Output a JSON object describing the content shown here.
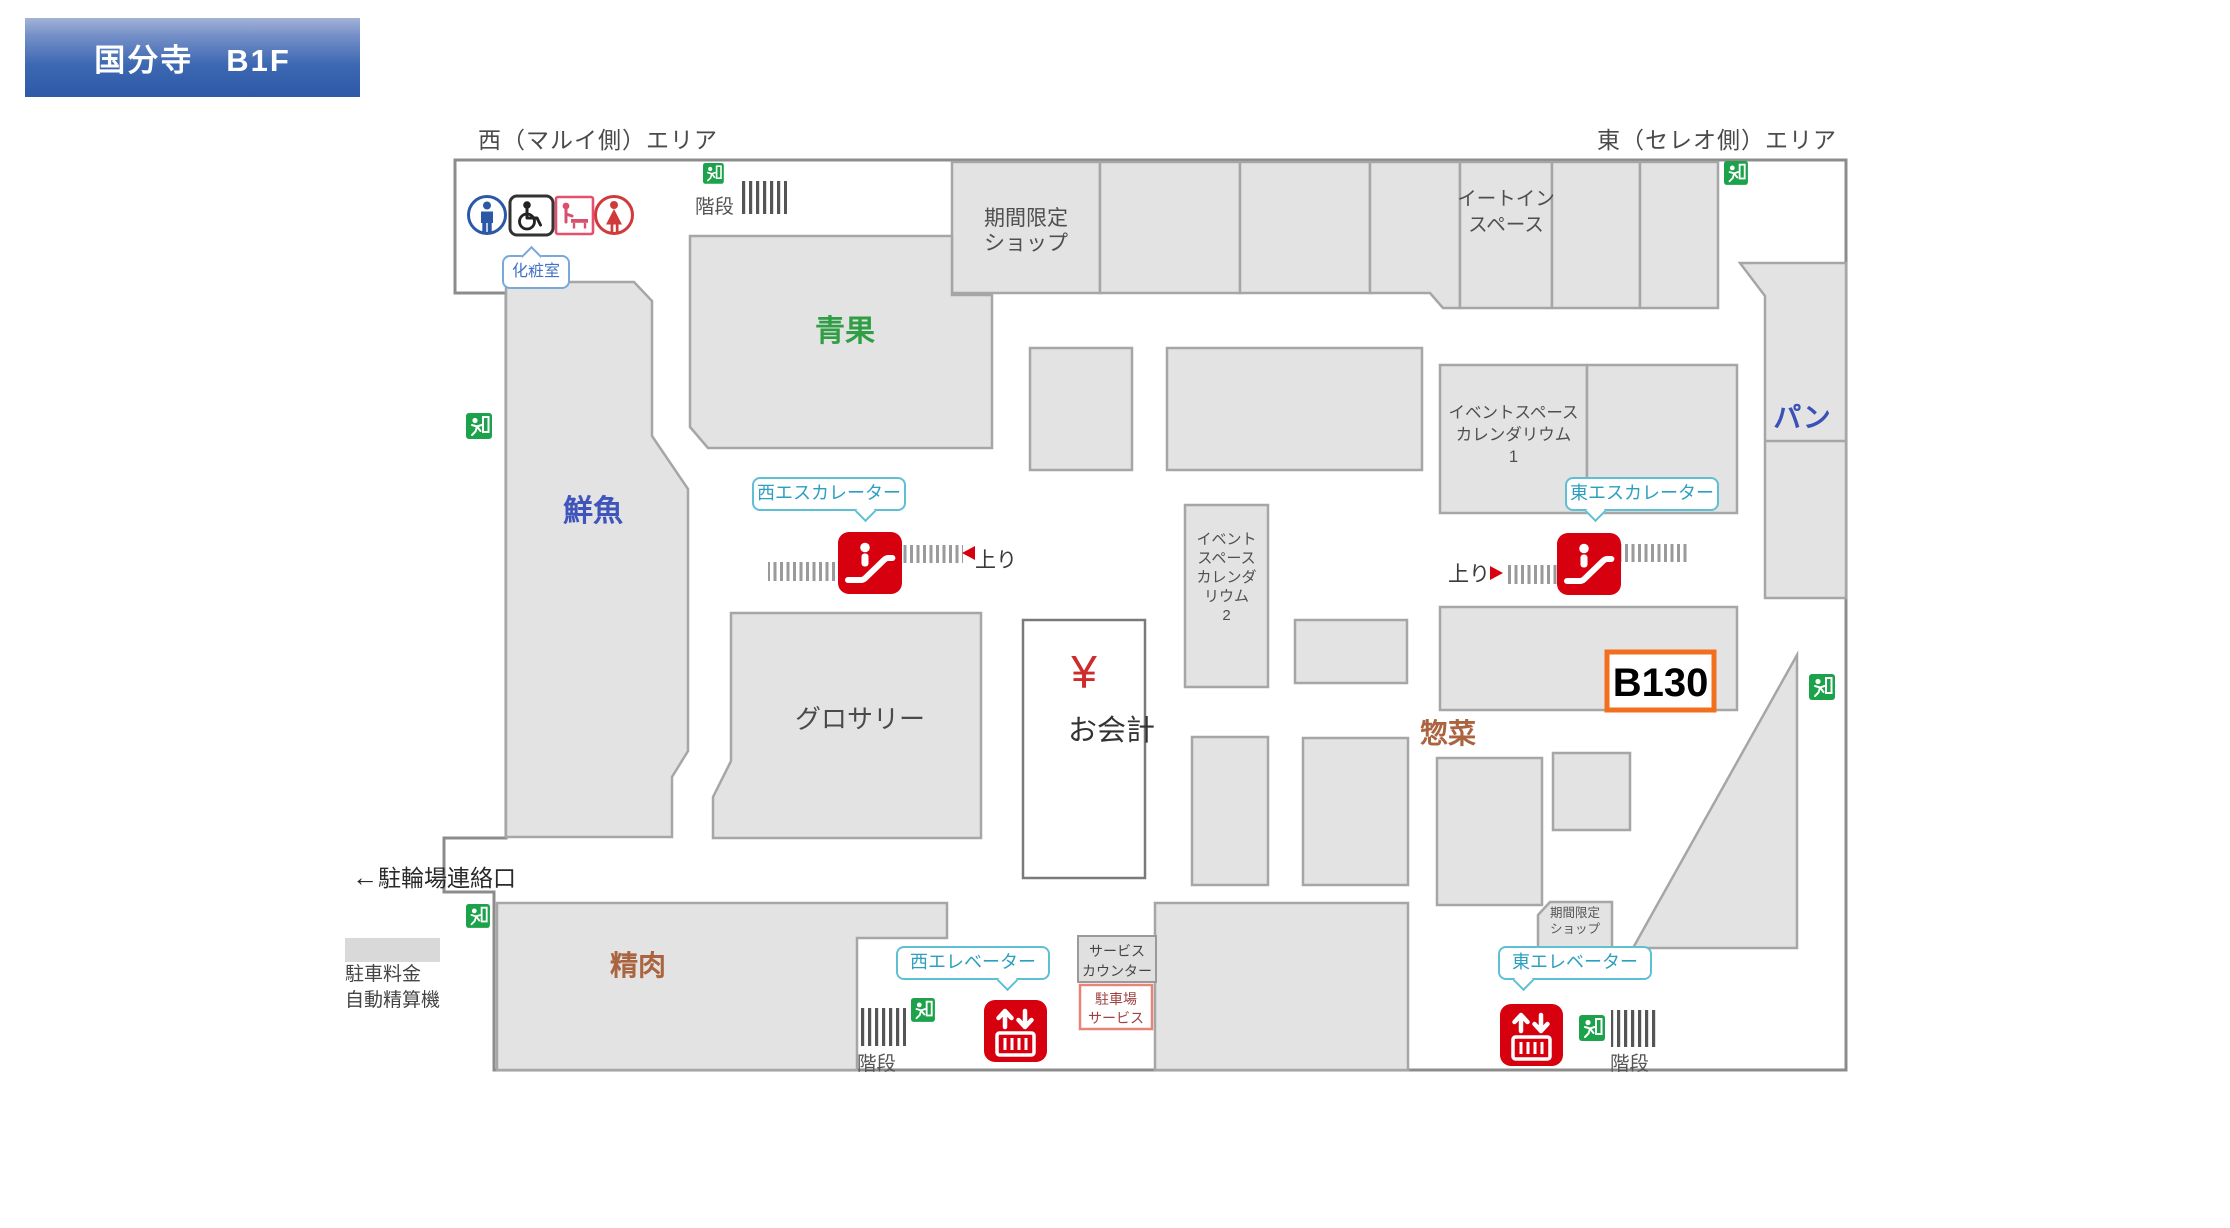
{
  "banner": {
    "title": "国分寺　B1F"
  },
  "area_labels": {
    "west": "西（マルイ側）エリア",
    "east": "東（セレオ側）エリア"
  },
  "sections": {
    "produce": "青果",
    "fresh_fish": "鮮魚",
    "grocery": "グロサリー",
    "bread": "パン",
    "deli": "惣菜",
    "meat": "精肉",
    "limited_shop": "期間限定\nショップ",
    "limited_shop_small": "期間限定\nショップ",
    "eat_in": "イートイン\nスペース",
    "event_space_1": "イベントスペース\nカレンダリウム\n1",
    "event_space_2": "イベント\nスペース\nカレンダ\nリウム\n2"
  },
  "checkout": {
    "yen": "¥",
    "label": "お会計"
  },
  "booth_badge": "B130",
  "facilities": {
    "restroom": "化粧室",
    "stairs": "階段",
    "up": "上り",
    "west_escalator": "西エスカレーター",
    "east_escalator": "東エスカレーター",
    "west_elevator": "西エレベーター",
    "east_elevator": "東エレベーター",
    "bicycle_arrow": "←",
    "bicycle_exit": "駐輪場連絡口",
    "parking_fee_machine": "駐車料金\n自動精算機",
    "service_counter": "サービス\nカウンター",
    "parking_service": "駐車場\nサービス"
  },
  "colors": {
    "banner_blue": "#3a64b0",
    "map_wall": "#8c8c8c",
    "block_fill": "#e3e3e3",
    "block_border": "#a6a6a6",
    "accent_red": "#d7000f",
    "exit_green": "#1ba24a",
    "badge_orange": "#f26f1f",
    "bubble_teal": "#5fc0d4",
    "text_blue": "#3f55bb",
    "text_green": "#2f9e44",
    "text_brown": "#aa6440"
  }
}
